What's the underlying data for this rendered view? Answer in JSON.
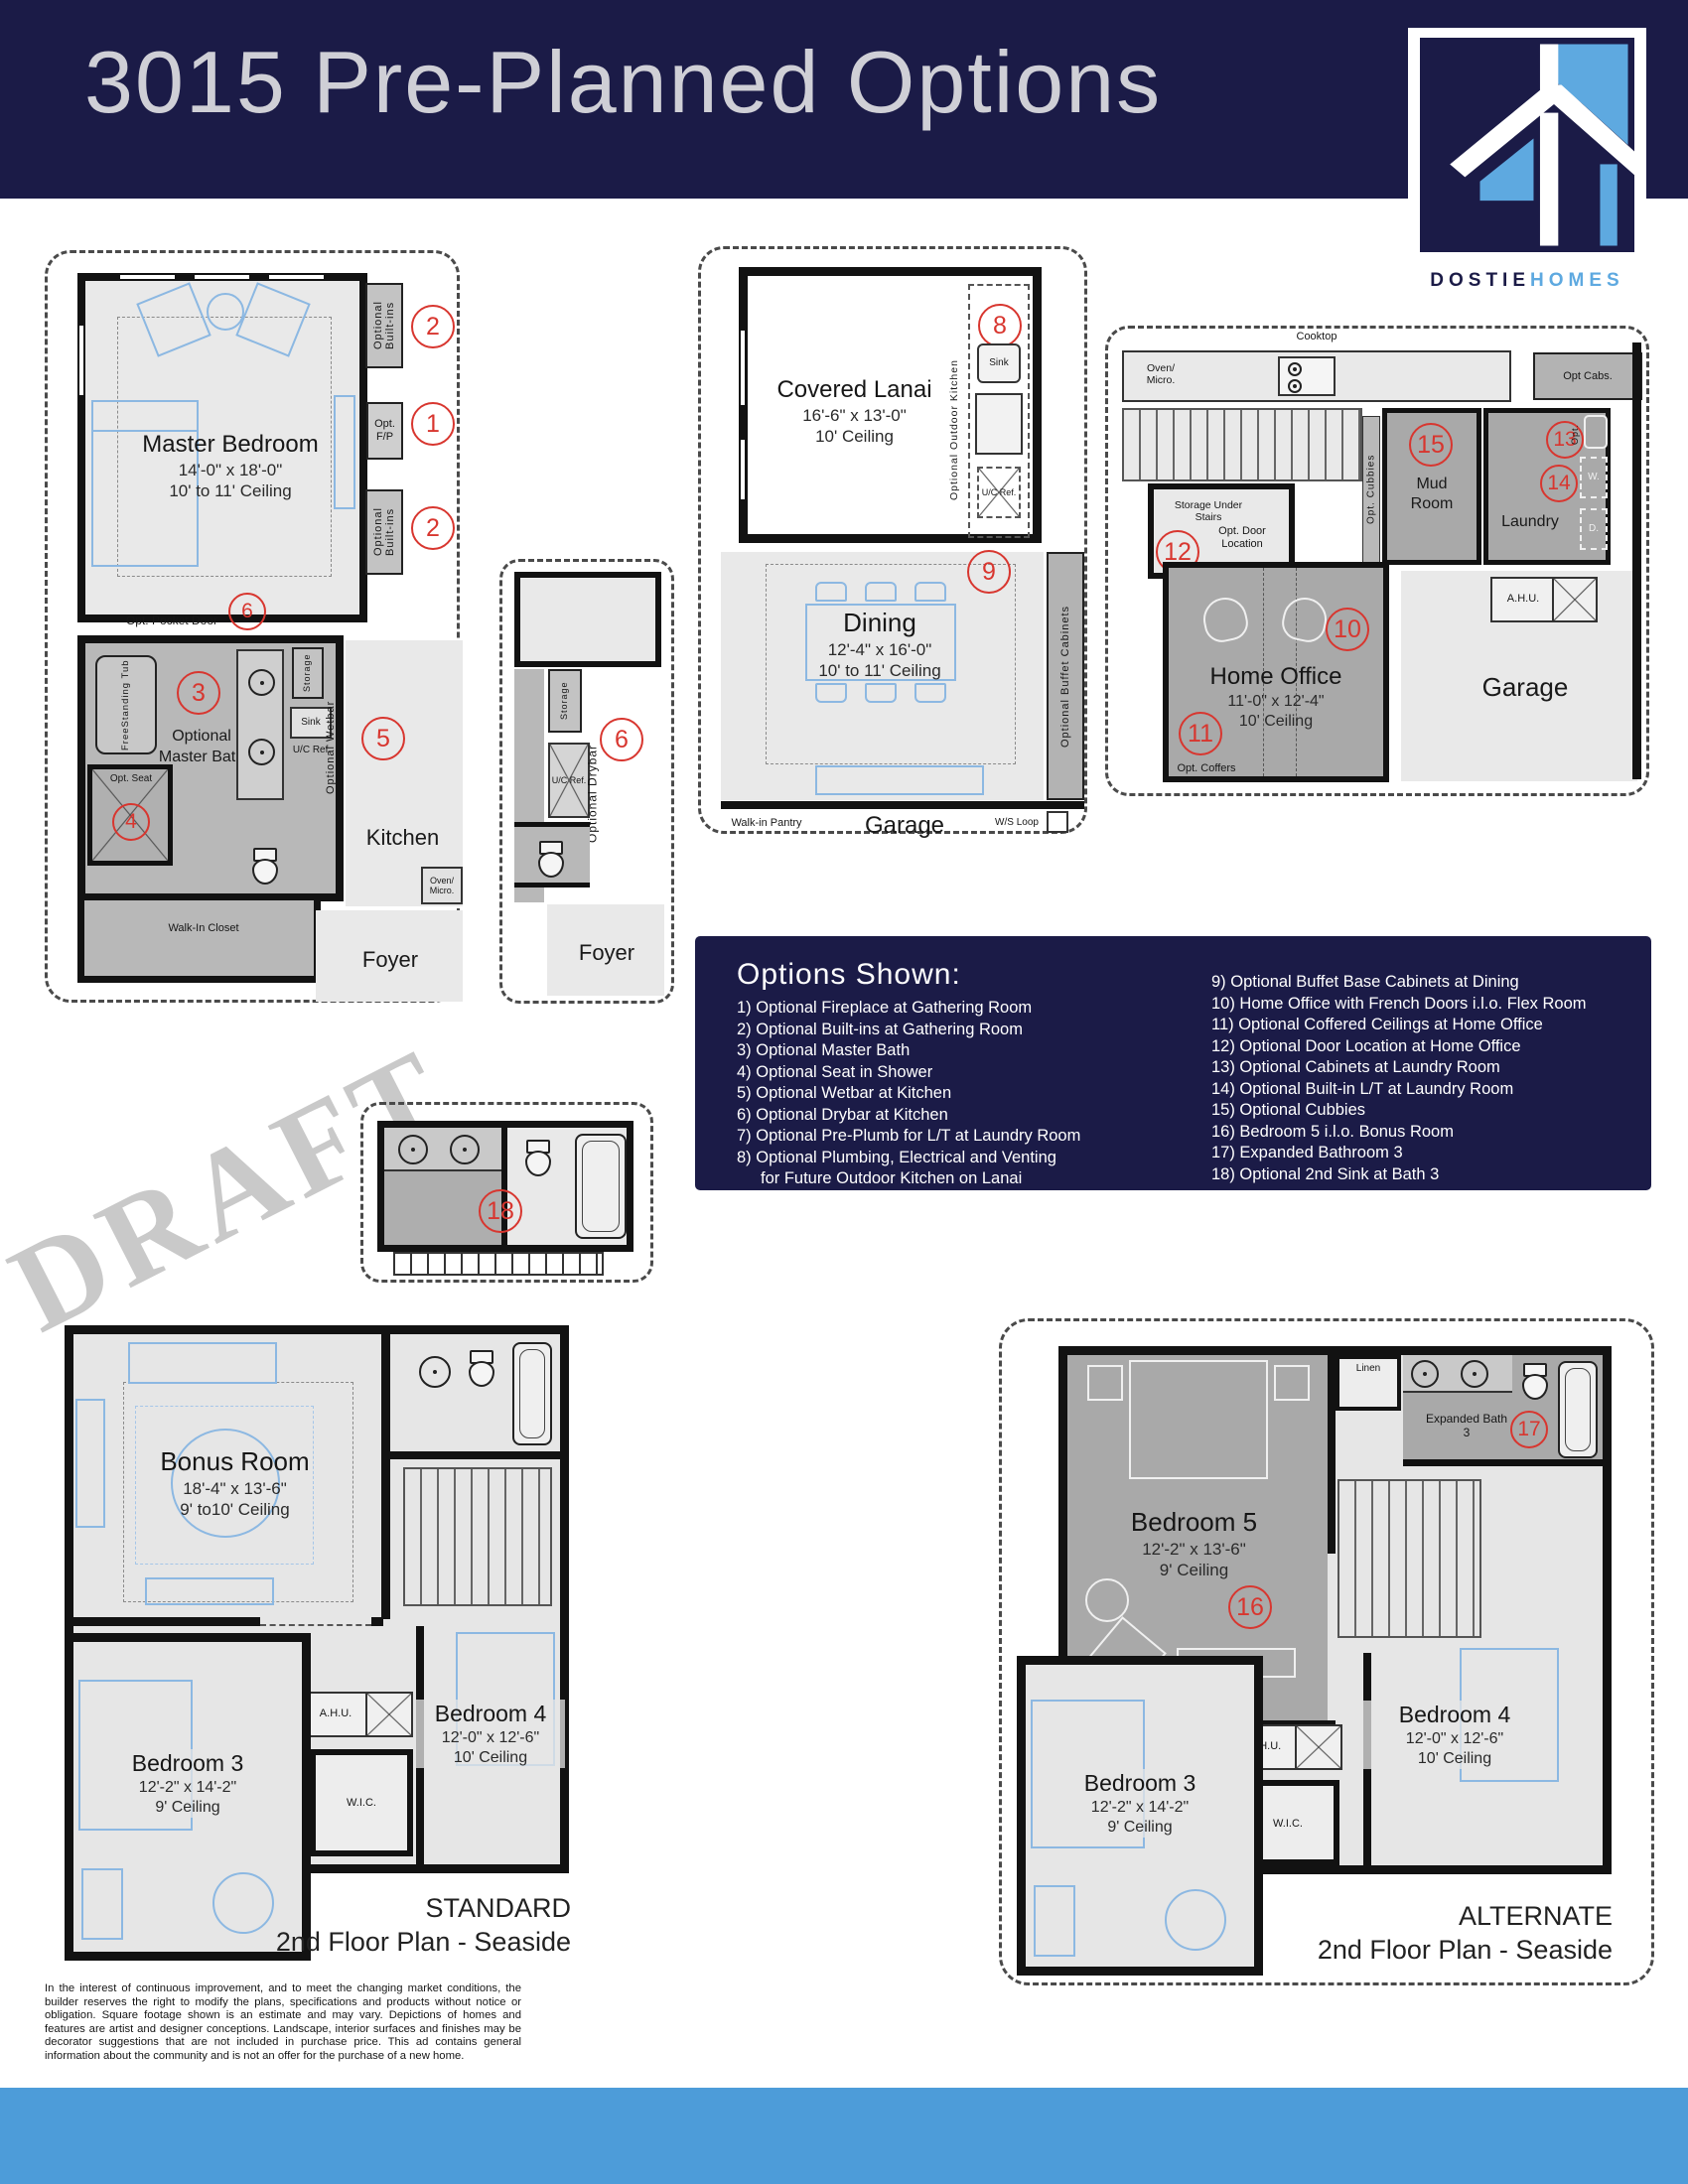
{
  "header": {
    "title": "3015 Pre-Planned Options",
    "brand_dark": "DOSTIE",
    "brand_light": "HOMES"
  },
  "watermark": "DRAFT",
  "plan_master": {
    "room_name": "Master Bedroom",
    "room_dims": "14'-0\" x 18'-0\"",
    "room_ceiling": "10' to 11' Ceiling",
    "built_ins_top": "Optional Built-ins",
    "built_ins_bottom": "Optional Built-ins",
    "opt_fp": "Opt. F/P",
    "pocket_door": "Opt. Pocket Door",
    "bath_label": "Optional Master Bath",
    "tub": "FreeStanding Tub",
    "opt_seat": "Opt. Seat",
    "storage": "Storage",
    "sink": "Sink",
    "uc_ref": "U/C Ref.",
    "wetbar": "Optional Wetbar",
    "kitchen": "Kitchen",
    "oven_micro": "Oven/ Micro.",
    "walk_in_closet": "Walk-In Closet",
    "foyer": "Foyer",
    "n2a": "2",
    "n1": "1",
    "n2b": "2",
    "n6": "6",
    "n3": "3",
    "n5": "5",
    "n4": "4"
  },
  "plan_drybar": {
    "storage": "Storage",
    "uc_ref": "U/C Ref.",
    "drybar": "Optional Drybar",
    "foyer": "Foyer",
    "n6": "6"
  },
  "plan_lanai": {
    "lanai_name": "Covered Lanai",
    "lanai_dims": "16'-6\" x 13'-0\"",
    "lanai_ceiling": "10' Ceiling",
    "outdoor_kitchen": "Optional Outdoor Kitchen",
    "sink": "Sink",
    "uc_ref": "U/C Ref.",
    "dining_name": "Dining",
    "dining_dims": "12'-4\" x 16'-0\"",
    "dining_ceiling": "10' to 11' Ceiling",
    "buffet": "Optional Buffet Cabinets",
    "pantry": "Walk-in Pantry",
    "garage": "Garage",
    "ws_loop": "W/S Loop",
    "n8": "8",
    "n9": "9"
  },
  "plan_office": {
    "cooktop": "Cooktop",
    "oven_micro": "Oven/ Micro.",
    "opt_cabs": "Opt Cabs.",
    "mud_room": "Mud Room",
    "opt_cubbies": "Opt. Cubbies",
    "laundry": "Laundry",
    "opt_lt": "Opt.",
    "washer": "W.",
    "dryer": "D.",
    "storage_under_stairs": "Storage Under Stairs",
    "opt_door": "Opt. Door Location",
    "office_name": "Home Office",
    "office_dims": "11'-0\" x 12'-4\"",
    "office_ceiling": "10' Ceiling",
    "opt_coffers": "Opt. Coffers",
    "ahu": "A.H.U.",
    "garage": "Garage",
    "n15": "15",
    "n13": "13",
    "n14": "14",
    "n12": "12",
    "n10": "10",
    "n11": "11"
  },
  "plan_bath18": {
    "n18": "18"
  },
  "options_panel": {
    "title": "Options Shown:",
    "left": [
      "1) Optional Fireplace at Gathering Room",
      "2) Optional Built-ins at Gathering Room",
      "3) Optional Master Bath",
      "4) Optional Seat in Shower",
      "5) Optional Wetbar at Kitchen",
      "6) Optional Drybar at Kitchen",
      "7) Optional Pre-Plumb for L/T at Laundry Room",
      "8) Optional Plumbing, Electrical and Venting",
      "for Future Outdoor Kitchen on Lanai"
    ],
    "right": [
      "9) Optional Buffet Base Cabinets at Dining",
      "10) Home Office with French Doors i.l.o. Flex Room",
      "11) Optional Coffered Ceilings at Home Office",
      "12) Optional Door Location at Home Office",
      "13) Optional Cabinets at Laundry Room",
      "14) Optional Built-in L/T at Laundry Room",
      "15) Optional Cubbies",
      "16) Bedroom 5 i.l.o. Bonus Room",
      "17) Expanded Bathroom 3",
      "18) Optional 2nd Sink at Bath 3"
    ]
  },
  "plan_standard": {
    "bonus_name": "Bonus Room",
    "bonus_dims": "18'-4\" x 13'-6\"",
    "bonus_ceiling": "9' to10' Ceiling",
    "bed3_name": "Bedroom 3",
    "bed3_dims": "12'-2\" x 14'-2\"",
    "bed3_ceiling": "9' Ceiling",
    "bed4_name": "Bedroom 4",
    "bed4_dims": "12'-0\" x 12'-6\"",
    "bed4_ceiling": "10' Ceiling",
    "ahu": "A.H.U.",
    "wic": "W.I.C.",
    "caption1": "STANDARD",
    "caption2": "2nd Floor Plan - Seaside"
  },
  "plan_alternate": {
    "bed5_name": "Bedroom 5",
    "bed5_dims": "12'-2\" x 13'-6\"",
    "bed5_ceiling": "9' Ceiling",
    "linen": "Linen",
    "bath3": "Expanded Bath 3",
    "bed3_name": "Bedroom 3",
    "bed3_dims": "12'-2\" x 14'-2\"",
    "bed3_ceiling": "9' Ceiling",
    "bed4_name": "Bedroom 4",
    "bed4_dims": "12'-0\" x 12'-6\"",
    "bed4_ceiling": "10' Ceiling",
    "ahu": "A.H.U.",
    "wic": "W.I.C.",
    "caption1": "ALTERNATE",
    "caption2": "2nd Floor Plan - Seaside",
    "n16": "16",
    "n17": "17"
  },
  "disclaimer": "In the interest of continuous improvement, and to meet the changing market conditions, the builder reserves the right to modify the plans, specifications and products without notice or obligation. Square footage shown is an estimate and may vary. Depictions of homes and features are artist and designer conceptions. Landscape, interior surfaces and finishes may be decorator suggestions that are not included in purchase price. This ad contains general information about the community and is not an offer for the purchase of a new home.",
  "colors": {
    "navy": "#1b1b47",
    "title_gray": "#cfcfd6",
    "logo_blue": "#5ea9e0",
    "badge_red": "#d8362f",
    "footer_blue": "#4d9cd9"
  }
}
